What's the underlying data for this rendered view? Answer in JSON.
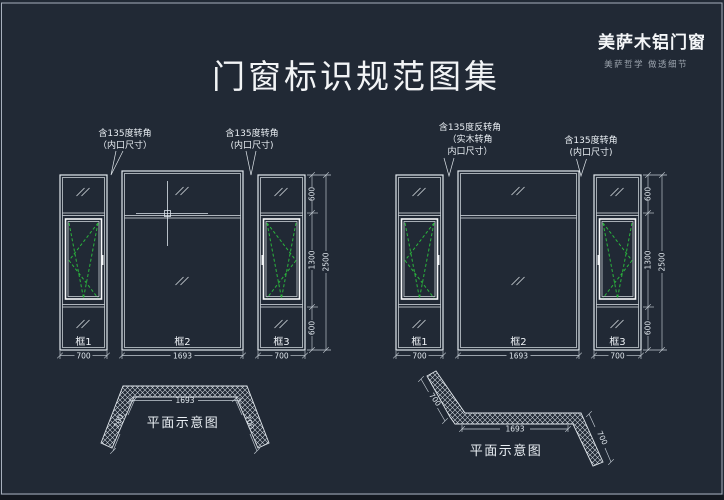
{
  "window": {
    "title": "门窗标识规范图集"
  },
  "brand": {
    "name": "美萨木铝门窗",
    "tagline": "美萨哲学 做透细节"
  },
  "colors": {
    "background": "#212935",
    "line": "#e2e8ee",
    "green": "#2ab43c",
    "dim": "#c6ced6"
  },
  "left_diagram": {
    "annotation_left": {
      "line1": "含135度转角",
      "line2": "（内口尺寸）"
    },
    "annotation_right": {
      "line1": "含135度转角",
      "line2": "(内口尺寸)"
    },
    "frame1": "框1",
    "frame2": "框2",
    "frame3": "框3",
    "width1": "700",
    "width2": "1693",
    "width3": "700",
    "height_top": "600",
    "height_middle": "1300",
    "height_bottom": "600",
    "height_total": "2500",
    "plan": {
      "title": "平面示意图",
      "dim_middle": "1693",
      "dim_left": "700",
      "dim_right": "700"
    }
  },
  "right_diagram": {
    "annotation_left": {
      "line1": "含135度反转角",
      "line2": "（实木转角",
      "line3": "内口尺寸）"
    },
    "annotation_right": {
      "line1": "含135度转角",
      "line2": "(内口尺寸)"
    },
    "frame1": "框1",
    "frame2": "框2",
    "frame3": "框3",
    "width1": "700",
    "width2": "1693",
    "width3": "700",
    "height_top": "600",
    "height_middle": "1300",
    "height_bottom": "600",
    "height_total": "2500",
    "plan": {
      "title": "平面示意图",
      "dim_middle": "1693",
      "dim_left": "700",
      "dim_right": "700"
    }
  }
}
